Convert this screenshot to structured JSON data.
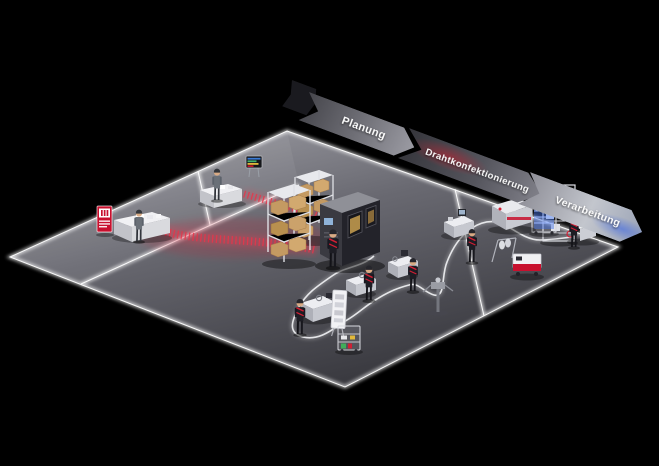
{
  "banners": {
    "items": [
      {
        "id": "planung",
        "label": "Planung"
      },
      {
        "id": "drahtkonfektionierung",
        "label": "Drahtkonfektionierung"
      },
      {
        "id": "verarbeitung",
        "label": "Verarbeitung"
      }
    ]
  },
  "colors": {
    "background": "#000000",
    "accent_red": "#d21e33",
    "banner_blue_glow": "#486ee0",
    "floor_light": "#a7a7ae",
    "floor_dark": "#38383e",
    "edge_glow": "#ffffff",
    "box_tan": "#c49a62"
  }
}
